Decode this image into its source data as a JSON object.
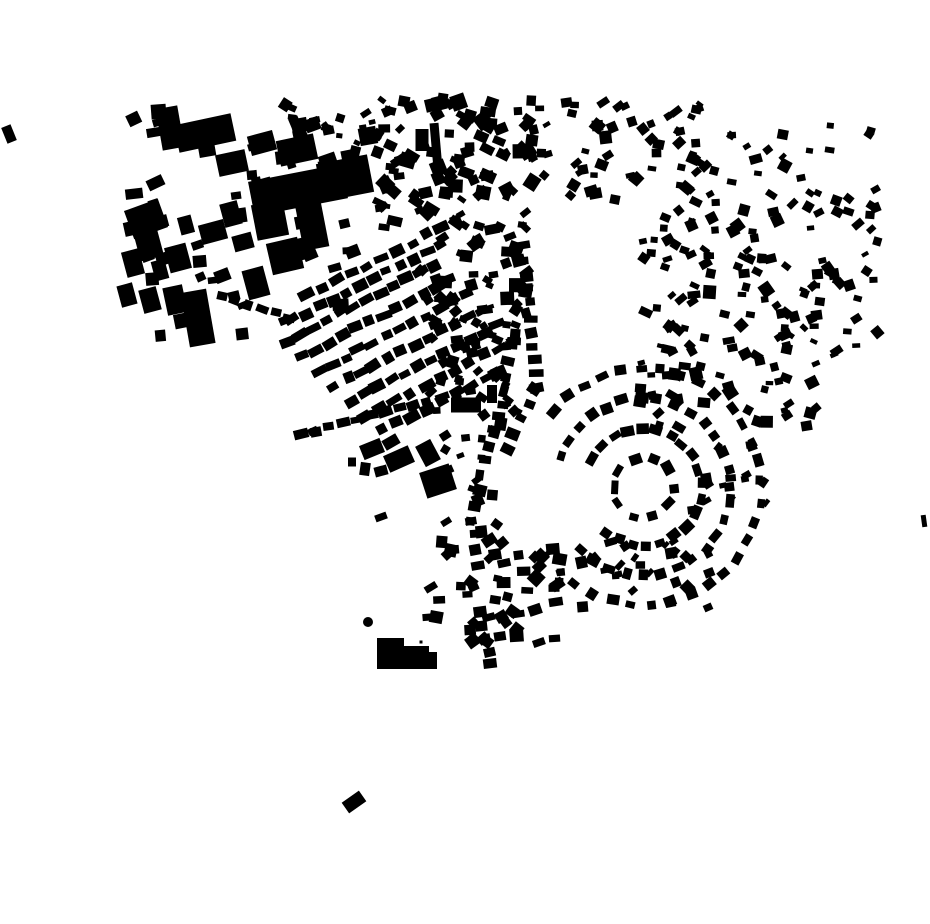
{
  "map_content": {
    "background": "#ffffff",
    "building_color": "#000000",
    "canvas": {
      "width": 930,
      "height": 924
    },
    "seed": 7,
    "landmarks": [
      [
        146,
        219,
        36,
        30,
        -20
      ],
      [
        170,
        128,
        22,
        42,
        -10
      ],
      [
        205,
        133,
        58,
        28,
        -12
      ],
      [
        262,
        143,
        26,
        20,
        -15
      ],
      [
        232,
        163,
        30,
        22,
        -12
      ],
      [
        297,
        150,
        38,
        26,
        -12
      ],
      [
        148,
        242,
        24,
        34,
        -15
      ],
      [
        178,
        258,
        22,
        26,
        -15
      ],
      [
        213,
        232,
        26,
        20,
        -15
      ],
      [
        243,
        242,
        20,
        16,
        -15
      ],
      [
        133,
        263,
        18,
        26,
        -15
      ],
      [
        160,
        270,
        14,
        20,
        -15
      ],
      [
        127,
        295,
        16,
        22,
        -15
      ],
      [
        150,
        300,
        18,
        24,
        -15
      ],
      [
        175,
        300,
        20,
        28,
        -12
      ],
      [
        198,
        318,
        26,
        55,
        -10
      ],
      [
        256,
        283,
        22,
        30,
        -15
      ],
      [
        231,
        214,
        18,
        24,
        -15
      ],
      [
        186,
        225,
        14,
        18,
        -15
      ],
      [
        160,
        222,
        16,
        12,
        -15
      ],
      [
        298,
        190,
        95,
        35,
        -11
      ],
      [
        345,
        178,
        52,
        38,
        -11
      ],
      [
        312,
        225,
        26,
        48,
        -11
      ],
      [
        270,
        220,
        32,
        36,
        -11
      ],
      [
        285,
        256,
        32,
        32,
        -13
      ],
      [
        306,
        248,
        16,
        22,
        -13
      ],
      [
        436,
        146,
        9,
        46,
        -5
      ],
      [
        422,
        140,
        13,
        22,
        0
      ],
      [
        466,
        405,
        30,
        15,
        0
      ],
      [
        492,
        394,
        10,
        18,
        0
      ],
      [
        372,
        449,
        22,
        15,
        -22
      ],
      [
        391,
        442,
        16,
        11,
        -30
      ],
      [
        399,
        459,
        27,
        18,
        -24
      ],
      [
        381,
        471,
        13,
        10,
        -15
      ],
      [
        365,
        469,
        10,
        13,
        8
      ],
      [
        428,
        453,
        17,
        23,
        -28
      ],
      [
        438,
        481,
        31,
        27,
        -18
      ],
      [
        352,
        462,
        8,
        9,
        0
      ],
      [
        381,
        517,
        12,
        7,
        -20
      ],
      [
        313,
        431,
        10,
        7,
        -25
      ],
      [
        9,
        134,
        10,
        17,
        -22
      ],
      [
        924,
        521,
        5,
        12,
        -8
      ],
      [
        354,
        802,
        21,
        13,
        -35
      ],
      [
        421,
        642,
        3,
        3,
        0
      ]
    ],
    "polygons": [
      {
        "points": "377,638 404,638 404,646 429,646 429,652 437,652 437,669 377,669"
      }
    ],
    "circles": [
      [
        368,
        622,
        5
      ]
    ],
    "rows": [
      [
        308,
        296,
        456,
        220,
        11,
        13,
        9
      ],
      [
        292,
        320,
        440,
        244,
        12,
        13,
        9
      ],
      [
        286,
        341,
        434,
        265,
        12,
        13,
        9
      ],
      [
        302,
        356,
        450,
        280,
        12,
        13,
        9
      ],
      [
        318,
        371,
        466,
        295,
        12,
        13,
        9
      ],
      [
        334,
        386,
        482,
        310,
        12,
        13,
        9
      ],
      [
        350,
        401,
        498,
        325,
        12,
        13,
        9
      ],
      [
        366,
        416,
        514,
        340,
        11,
        13,
        9
      ],
      [
        382,
        431,
        500,
        371,
        9,
        13,
        9
      ],
      [
        300,
        434,
        470,
        390,
        13,
        12,
        8
      ],
      [
        523,
        247,
        537,
        388,
        11,
        9,
        12
      ],
      [
        536,
        390,
        506,
        448,
        5,
        9,
        11
      ],
      [
        514,
        333,
        496,
        432,
        8,
        10,
        11
      ],
      [
        490,
        430,
        472,
        520,
        7,
        10,
        11
      ],
      [
        472,
        520,
        478,
        566,
        4,
        10,
        11
      ],
      [
        479,
        612,
        491,
        664,
        5,
        10,
        11
      ],
      [
        222,
        295,
        290,
        318,
        6,
        11,
        8
      ]
    ],
    "arcs": [
      [
        643,
        487,
        30,
        0,
        324,
        10,
        11,
        9
      ],
      [
        643,
        487,
        58,
        -150,
        130,
        20,
        11,
        9
      ],
      [
        643,
        487,
        88,
        -160,
        135,
        27,
        11,
        9
      ],
      [
        643,
        487,
        118,
        -140,
        125,
        28,
        11,
        9
      ]
    ],
    "scatters": [
      [
        378,
        98,
        170,
        130,
        110,
        7,
        16,
        0,
        45
      ],
      [
        420,
        228,
        108,
        115,
        55,
        7,
        15,
        0,
        45
      ],
      [
        285,
        98,
        95,
        70,
        22,
        6,
        11,
        0,
        40
      ],
      [
        565,
        100,
        195,
        100,
        60,
        7,
        13,
        0,
        45
      ],
      [
        640,
        200,
        120,
        85,
        35,
        7,
        13,
        0,
        45
      ],
      [
        760,
        118,
        118,
        240,
        60,
        7,
        12,
        0,
        45
      ],
      [
        640,
        285,
        180,
        145,
        80,
        7,
        13,
        0,
        45
      ],
      [
        425,
        540,
        140,
        110,
        55,
        8,
        14,
        -20,
        35
      ],
      [
        430,
        345,
        90,
        95,
        25,
        7,
        12,
        0,
        45
      ],
      [
        445,
        435,
        60,
        100,
        14,
        7,
        12,
        0,
        40
      ],
      [
        125,
        105,
        245,
        235,
        55,
        9,
        18,
        -15,
        12
      ],
      [
        580,
        540,
        130,
        80,
        25,
        7,
        12,
        -30,
        30
      ],
      [
        690,
        440,
        80,
        80,
        14,
        7,
        11,
        -30,
        30
      ]
    ]
  }
}
